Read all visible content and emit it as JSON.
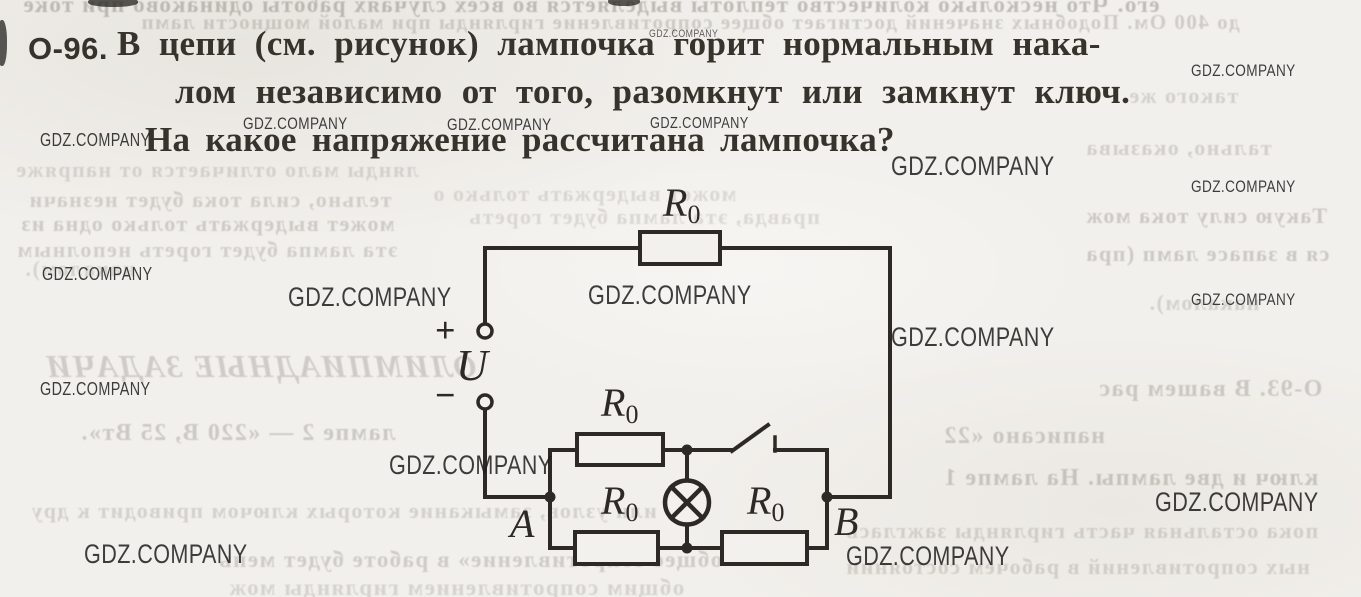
{
  "problem": {
    "number": "О-96.",
    "line1": "В цепи (см. рисунок) лампочка горит нормальным нака-",
    "line2": "лом независимо от того, разомкнут или замкнут ключ.",
    "line3": "На какое напряжение рассчитана лампочка?"
  },
  "circuit": {
    "resistor_label": "R",
    "resistor_sub": "0",
    "source_label": "U",
    "plus": "+",
    "minus": "−",
    "node_a": "A",
    "node_b": "B",
    "ink_color": "#2d2a25",
    "paper_color": "#f3f1ee"
  },
  "watermark": {
    "text": "GDZ.COMPANY",
    "color": "#1d1d1d",
    "items": [
      {
        "x": 649,
        "y": 29,
        "size": 11,
        "opacity": 0.7
      },
      {
        "x": 1191,
        "y": 62,
        "size": 17
      },
      {
        "x": 243,
        "y": 115,
        "size": 17
      },
      {
        "x": 447,
        "y": 116,
        "size": 17
      },
      {
        "x": 650,
        "y": 116,
        "size": 16
      },
      {
        "x": 40,
        "y": 131,
        "size": 18
      },
      {
        "x": 891,
        "y": 153,
        "size": 27
      },
      {
        "x": 1191,
        "y": 178,
        "size": 17
      },
      {
        "x": 42,
        "y": 265,
        "size": 18
      },
      {
        "x": 288,
        "y": 284,
        "size": 27
      },
      {
        "x": 588,
        "y": 282,
        "size": 27
      },
      {
        "x": 1191,
        "y": 291,
        "size": 17
      },
      {
        "x": 891,
        "y": 324,
        "size": 27
      },
      {
        "x": 40,
        "y": 380,
        "size": 18
      },
      {
        "x": 389,
        "y": 452,
        "size": 27
      },
      {
        "x": 1155,
        "y": 489,
        "size": 27
      },
      {
        "x": 84,
        "y": 541,
        "size": 27
      },
      {
        "x": 846,
        "y": 543,
        "size": 27
      }
    ]
  },
  "bleed_through": {
    "items": [
      {
        "t": "его. Что несколько количество теплоты выделяется во всех случаях работы одинаково при токе",
        "x": 22,
        "y": -7,
        "size": 23,
        "opacity": 0.4
      },
      {
        "t": "до 400 Ом. Подобных значений достигает общее сопротивление гирлянды при малой мощности ламп",
        "x": 140,
        "y": 12,
        "size": 21,
        "opacity": 0.28
      },
      {
        "t": "лянды мало отличается от напряже",
        "x": 15,
        "y": 159,
        "size": 22,
        "opacity": 0.22
      },
      {
        "t": "тельно, сила тока будет незначи",
        "x": 28,
        "y": 189,
        "size": 22,
        "opacity": 0.26
      },
      {
        "t": "может выдержать только одна из",
        "x": 20,
        "y": 213,
        "size": 22,
        "opacity": 0.28
      },
      {
        "t": "эта лампа будет гореть неполным",
        "x": 16,
        "y": 239,
        "size": 22,
        "opacity": 0.26
      },
      {
        "t": "накалом).",
        "x": 24,
        "y": 258,
        "size": 22,
        "opacity": 0.22
      },
      {
        "t": "такого же",
        "x": 1128,
        "y": 85,
        "size": 22,
        "opacity": 0.24
      },
      {
        "t": "тально, оказыва",
        "x": 1085,
        "y": 137,
        "size": 22,
        "opacity": 0.25
      },
      {
        "t": "Такую силу тока мож",
        "x": 1085,
        "y": 205,
        "size": 22,
        "opacity": 0.3
      },
      {
        "t": "ся в запасе ламп (пра",
        "x": 1085,
        "y": 243,
        "size": 22,
        "opacity": 0.3
      },
      {
        "t": "накалом).",
        "x": 1148,
        "y": 292,
        "size": 22,
        "opacity": 0.24
      },
      {
        "t": "может выдержать только о",
        "x": 432,
        "y": 183,
        "size": 22,
        "opacity": 0.2
      },
      {
        "t": "правда, эта лампа будет гореть",
        "x": 468,
        "y": 206,
        "size": 22,
        "opacity": 0.2
      },
      {
        "t": "ОЛИМПИАДНЫЕ ЗАДАЧИ",
        "x": 45,
        "y": 350,
        "size": 32,
        "opacity": 0.28,
        "italic": true
      },
      {
        "t": "О-93. В вашем рас",
        "x": 1098,
        "y": 377,
        "size": 24,
        "opacity": 0.3
      },
      {
        "t": "написано «22",
        "x": 943,
        "y": 424,
        "size": 24,
        "opacity": 0.3
      },
      {
        "t": "ключ и две лампы. На лампе 1",
        "x": 943,
        "y": 466,
        "size": 24,
        "opacity": 0.32
      },
      {
        "t": "лампе 2 — «220 В, 25 Вт».",
        "x": 80,
        "y": 421,
        "size": 24,
        "opacity": 0.3
      },
      {
        "t": "или узлов, замыкание которых ключом приводит к дру",
        "x": 30,
        "y": 500,
        "size": 22,
        "opacity": 0.24
      },
      {
        "t": "общее сопротивление» в работе будет мень",
        "x": 218,
        "y": 548,
        "size": 23,
        "opacity": 0.28
      },
      {
        "t": "пока остальная часть гирлянды зажглась",
        "x": 845,
        "y": 520,
        "size": 22,
        "opacity": 0.24
      },
      {
        "t": "ных сопротивлений в рабочем состоянии",
        "x": 845,
        "y": 556,
        "size": 22,
        "opacity": 0.24
      },
      {
        "t": "общим сопротивлением гирлянды мож",
        "x": 228,
        "y": 576,
        "size": 23,
        "opacity": 0.22
      }
    ]
  }
}
